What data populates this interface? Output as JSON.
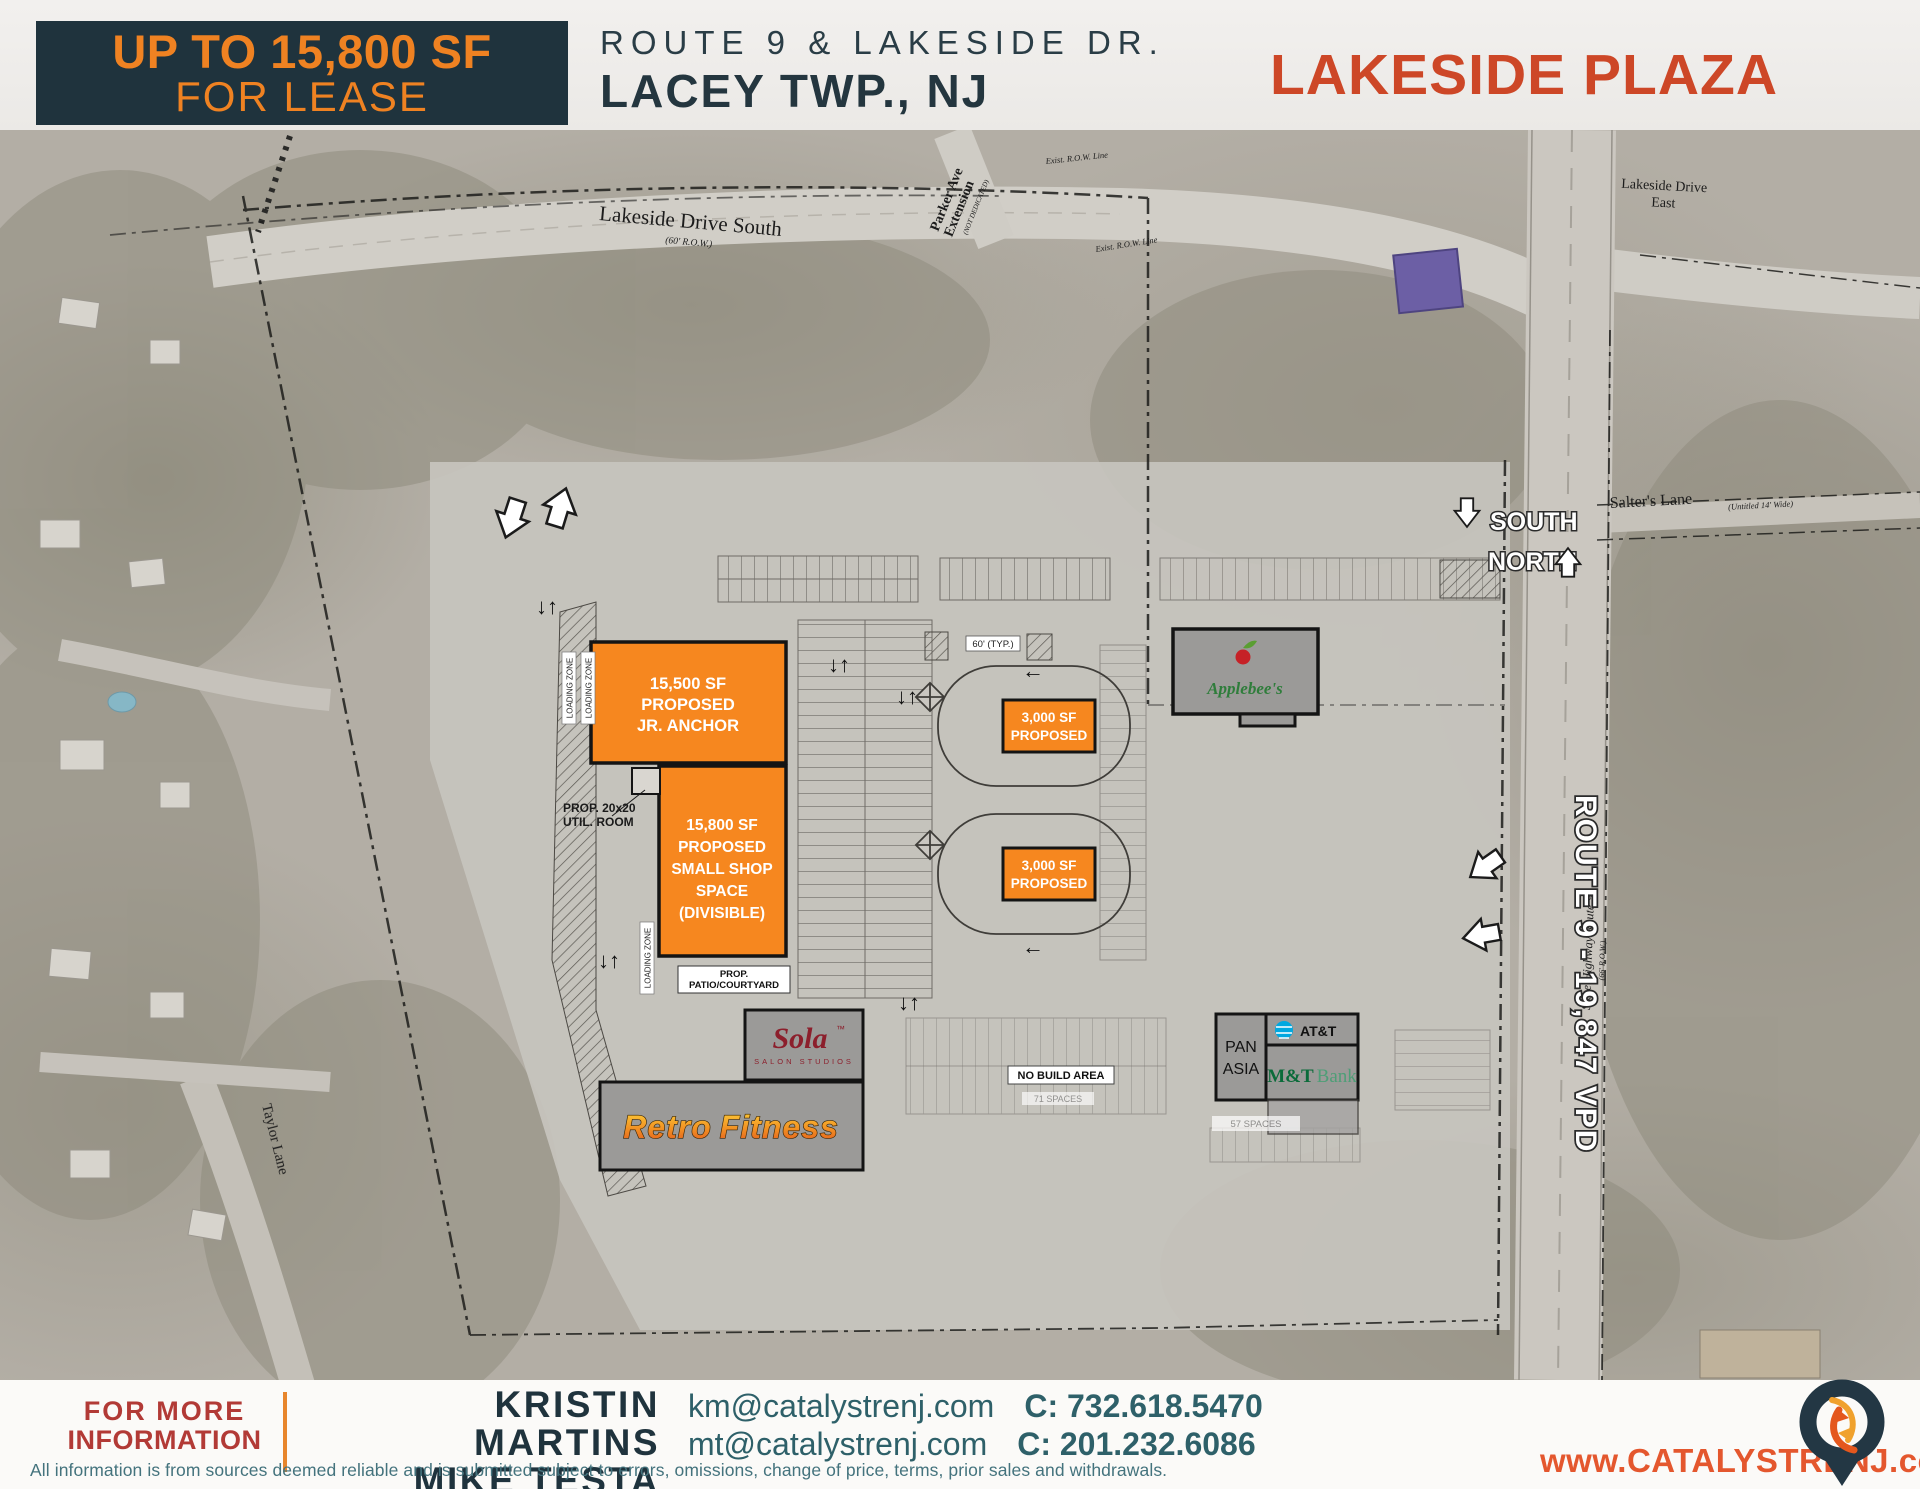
{
  "header": {
    "badge": {
      "line1": "UP TO 15,800 SF",
      "line2": "FOR LEASE"
    },
    "location": {
      "line1": "ROUTE 9 & LAKESIDE DR.",
      "line2": "LACEY TWP., NJ"
    },
    "plaza_name": "LAKESIDE PLAZA"
  },
  "map": {
    "roads": {
      "lakeside_south": "Lakeside Drive South",
      "lakeside_south_row": "(60' R.O.W.)",
      "parker_line1": "Parker Ave",
      "parker_line2": "Extension",
      "parker_note": "(NOT DEDICATED)",
      "lakeside_east_line1": "Lakeside Drive",
      "lakeside_east_line2": "East",
      "salters": "Salter's Lane",
      "salters_note": "(Untitled 14' Wide)",
      "taylor": "Taylor Lane",
      "route9_label": "ROUTE 9 - 19,847 VPD",
      "route9_plan": "State Highway Route 9",
      "route9_row": "(66' R.O.W.)",
      "exist_row": "Exist. R.O.W. Line"
    },
    "compass": {
      "south": "SOUTH",
      "north": "NORTH"
    },
    "buildings": {
      "jr_anchor": {
        "l1": "15,500 SF",
        "l2": "PROPOSED",
        "l3": "JR. ANCHOR"
      },
      "small_shop": {
        "l1": "15,800 SF",
        "l2": "PROPOSED",
        "l3": "SMALL SHOP",
        "l4": "SPACE",
        "l5": "(DIVISIBLE)"
      },
      "pad_a": {
        "l1": "3,000 SF",
        "l2": "PROPOSED"
      },
      "pad_b": {
        "l1": "3,000 SF",
        "l2": "PROPOSED"
      },
      "applebees": "Applebee's",
      "sola": {
        "name": "Sola",
        "tm": "™",
        "sub": "SALON STUDIOS"
      },
      "retro": {
        "w1": "Retro",
        "w2": "Fitness"
      },
      "pan_asia": {
        "l1": "PAN",
        "l2": "ASIA"
      },
      "att": "AT&T",
      "mtb": {
        "bold": "M&T",
        "light": "Bank"
      }
    },
    "notes": {
      "util1": "PROP. 20x20",
      "util2": "UTIL. ROOM",
      "patio1": "PROP.",
      "patio2": "PATIO/COURTYARD",
      "no_build": "NO BUILD AREA",
      "loading": "LOADING ZONE",
      "spaces57": "57 SPACES",
      "spaces71": "71 SPACES",
      "typ60": "60' (TYP.)"
    }
  },
  "footer": {
    "info": {
      "line1": "FOR MORE",
      "line2": "INFORMATION"
    },
    "agents": {
      "a1": "KRISTIN MARTINS",
      "a2": "MIKE TESTA"
    },
    "contacts": {
      "email1": "km@catalystrenj.com",
      "phone1": "C: 732.618.5470",
      "email2": "mt@catalystrenj.com",
      "phone2": "C: 201.232.6086"
    },
    "disclaimer": "All information is from sources deemed reliable and is submitted subject to errors, omissions, change of price, terms, prior sales and withdrawals.",
    "website": "www.CATALYSTRENJ.com"
  },
  "colors": {
    "accent_orange": "#f6871f",
    "brand_teal": "#1f333d",
    "plaza_red": "#cd4727",
    "footer_red": "#b23a36",
    "teal_text": "#2e6069",
    "web_orange": "#e4572e"
  }
}
